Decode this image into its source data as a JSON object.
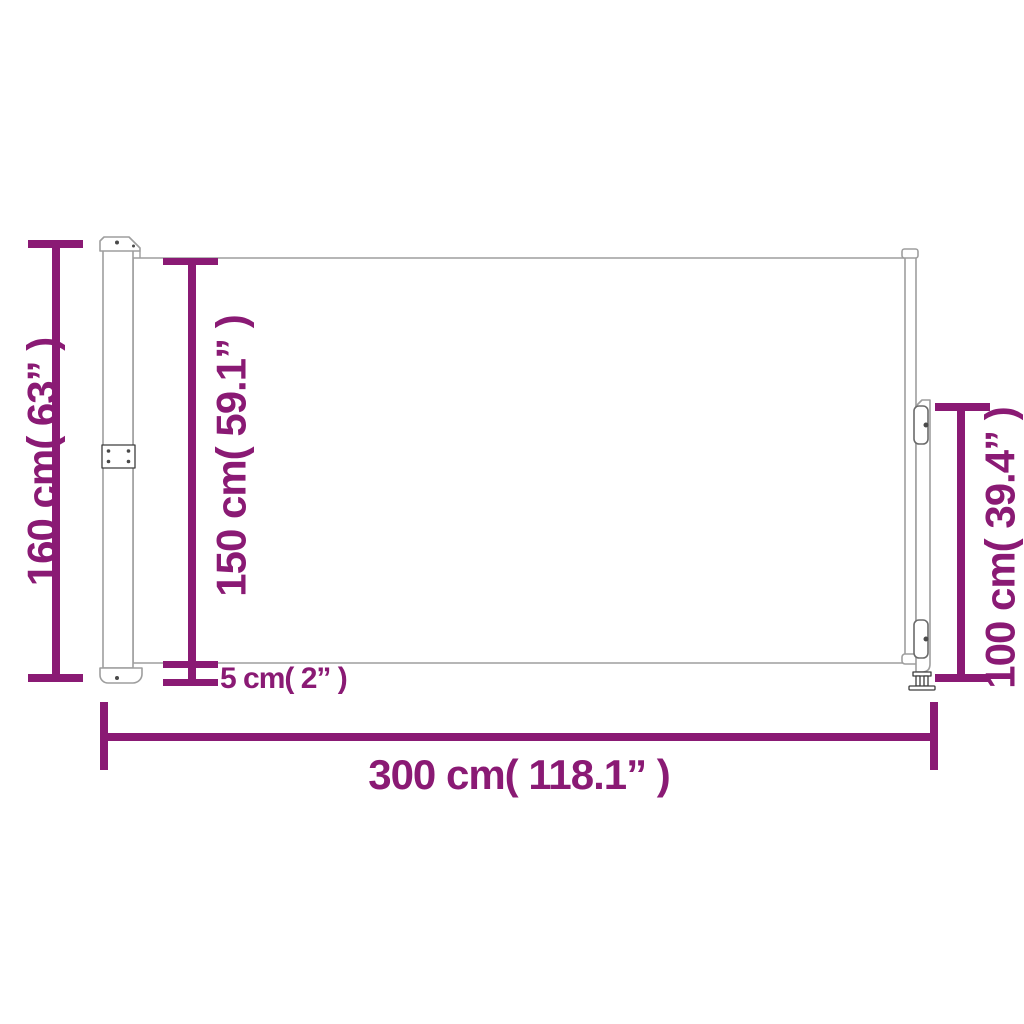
{
  "diagram": {
    "type": "product-dimension-diagram",
    "colors": {
      "dimension_accent": "#8a1a74",
      "product_outline": "#9e9e9e",
      "hardware_detail": "#3d3d3d",
      "background": "#ffffff"
    },
    "labels": {
      "total_height": "160 cm( 63” )",
      "fabric_height": "150 cm( 59.1” )",
      "ground_clearance": "5 cm( 2” )",
      "post_height": "100 cm( 39.4” )",
      "total_width": "300 cm( 118.1” )"
    }
  }
}
